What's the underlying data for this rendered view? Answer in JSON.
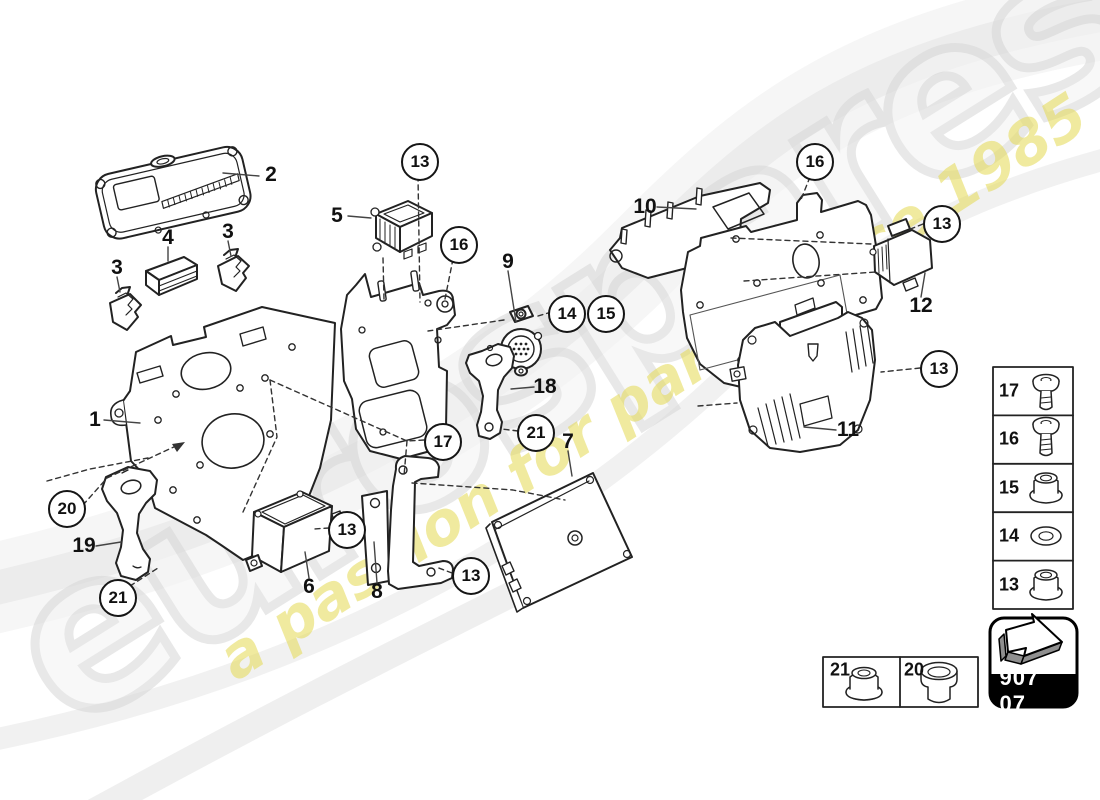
{
  "watermark": {
    "brand": "eurospares",
    "tagline": "a passion for parts since 1985"
  },
  "diagram_code": "907 07",
  "balloons": [
    {
      "label": "13"
    },
    {
      "label": "16"
    },
    {
      "label": "14"
    },
    {
      "label": "15"
    },
    {
      "label": "16"
    },
    {
      "label": "13"
    },
    {
      "label": "13"
    },
    {
      "label": "17"
    },
    {
      "label": "21"
    },
    {
      "label": "20"
    },
    {
      "label": "21"
    },
    {
      "label": "13"
    },
    {
      "label": "13"
    }
  ],
  "part_labels": [
    {
      "label": "1"
    },
    {
      "label": "2"
    },
    {
      "label": "3"
    },
    {
      "label": "3"
    },
    {
      "label": "4"
    },
    {
      "label": "5"
    },
    {
      "label": "6"
    },
    {
      "label": "7"
    },
    {
      "label": "8"
    },
    {
      "label": "9"
    },
    {
      "label": "10"
    },
    {
      "label": "11"
    },
    {
      "label": "12"
    },
    {
      "label": "18"
    },
    {
      "label": "19"
    }
  ],
  "fastener_legend": {
    "rows": [
      {
        "number": "17",
        "icon": "screw-short-icon"
      },
      {
        "number": "16",
        "icon": "screw-long-icon"
      },
      {
        "number": "15",
        "icon": "flange-nut-icon"
      },
      {
        "number": "14",
        "icon": "washer-icon"
      },
      {
        "number": "13",
        "icon": "flange-nut-icon"
      }
    ]
  },
  "hardware_legend": {
    "items": [
      {
        "number": "21",
        "icon": "flange-nut-icon"
      },
      {
        "number": "20",
        "icon": "bushing-icon"
      }
    ]
  },
  "colors": {
    "line": "#222222",
    "watermark_gray": "#d9d9d9",
    "watermark_yellow": "#e4d850",
    "badge_black": "#000000"
  }
}
